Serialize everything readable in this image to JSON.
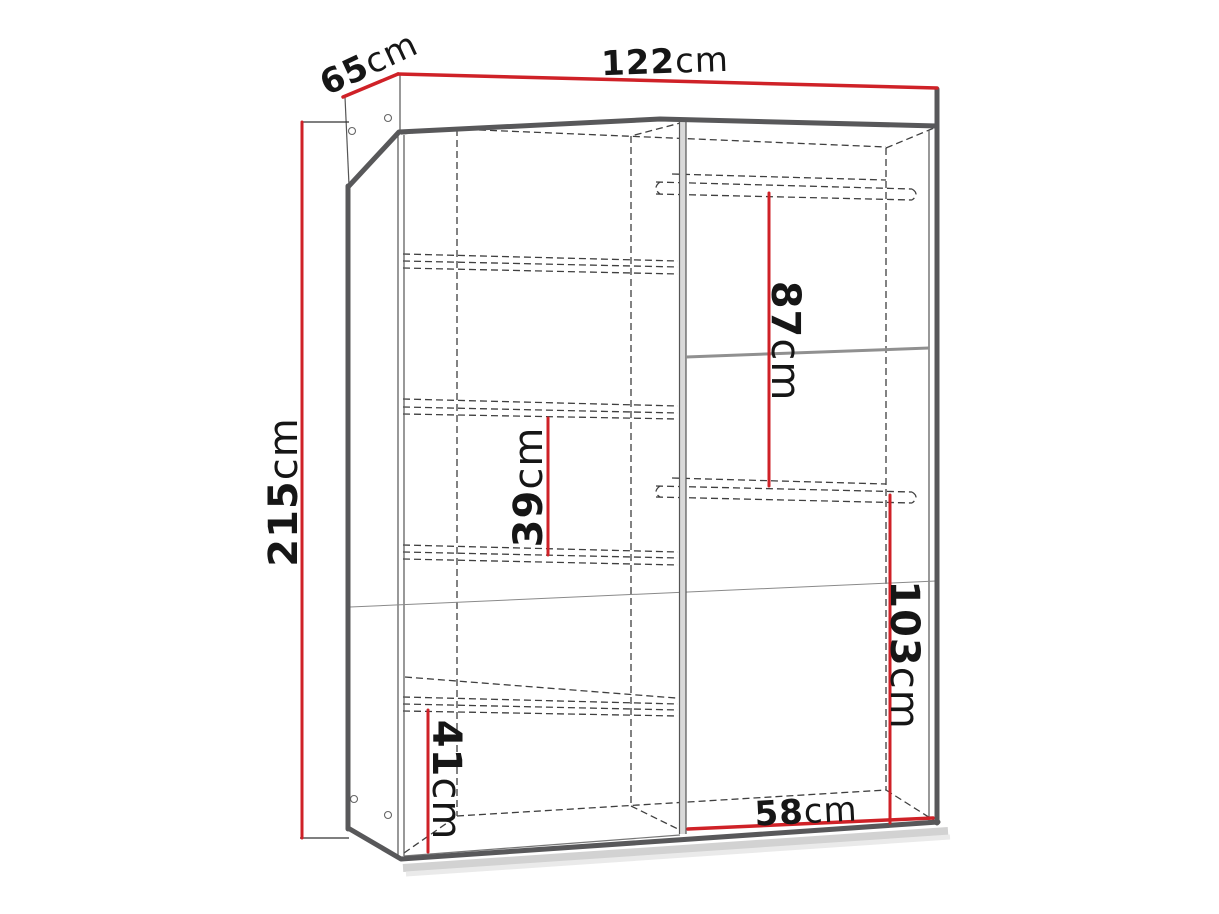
{
  "diagram": {
    "accent_color": "#cf2127",
    "outline_color": "#58585a",
    "dimensions": {
      "width_top": {
        "value": "122",
        "unit": "cm"
      },
      "depth_top_left": {
        "value": "65",
        "unit": "cm"
      },
      "height_left": {
        "value": "215",
        "unit": "cm"
      },
      "upper_right_gap": {
        "value": "87",
        "unit": "cm"
      },
      "middle_left_gap": {
        "value": "39",
        "unit": "cm"
      },
      "lower_left_gap": {
        "value": "41",
        "unit": "cm"
      },
      "lower_right_gap": {
        "value": "103",
        "unit": "cm"
      },
      "right_width": {
        "value": "58",
        "unit": "cm"
      }
    }
  }
}
